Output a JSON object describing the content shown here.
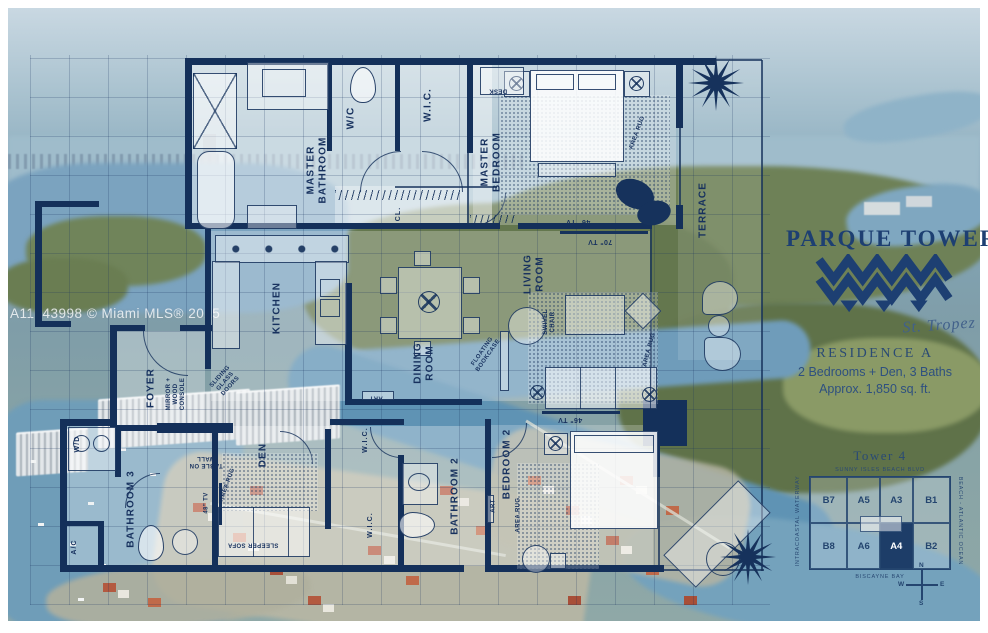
{
  "watermark": "A11843998 © Miami MLS® 2025",
  "brand": {
    "name": "PARQUE TOWERS",
    "signature": "St. Tropez"
  },
  "residence": {
    "title": "RESIDENCE A",
    "beds": "2 Bedrooms + Den, 3 Baths",
    "area": "Approx. 1,850 sq. ft."
  },
  "keyplan": {
    "title": "Tower 4",
    "street_top": "SUNNY ISLES BEACH BLVD",
    "street_bottom": "BISCAYNE BAY",
    "side_right": "BEACH - ATLANTIC OCEAN",
    "side_left": "INTRACOASTAL WATERWAY",
    "rows": [
      [
        "B7",
        "A5",
        "A3",
        "B1"
      ],
      [
        "B8",
        "A6",
        "A4",
        "B2"
      ]
    ],
    "highlight": "A4",
    "compass": {
      "n": "N",
      "s": "S",
      "e": "E",
      "w": "W"
    }
  },
  "floorplan": {
    "labels": {
      "master_bathroom": "MASTER\nBATHROOM",
      "wc": "W/C",
      "wic": "W.I.C.",
      "cl": "CL.",
      "master_bedroom": "MASTER\nBEDROOM",
      "terrace": "TERRACE",
      "kitchen": "KITCHEN",
      "dining_room": "DINING\nROOM",
      "living_room": "LIVING\nROOM",
      "foyer": "FOYER",
      "wd": "W/D",
      "bathroom_3": "BATHROOM 3",
      "ac": "A/C",
      "den": "DEN",
      "bathroom_2": "BATHROOM 2",
      "bedroom_2": "BEDROOM 2"
    },
    "annotations": {
      "desk": "DESK",
      "area_rug": "AREA RUG",
      "tv_46": "46\" TV",
      "tv_70": "70\" TV",
      "tv_48": "48\" TV",
      "floating_bookcase": "FLOATING\nBOOKCASE",
      "swivel_chair": "SWIVEL\nCHAIR",
      "mirror_console": "MIRROR +\nWOOD\nCONSOLE",
      "sliding_glass_doors": "SLIDING\nGLASS\nDOORS",
      "art": "ART",
      "sleeper_sofa": "SLEEPER SOFA",
      "table_on_wall": "TABLE ON\nWALL"
    }
  },
  "colors": {
    "navy": "#16325c",
    "accent": "#1d3f72"
  }
}
